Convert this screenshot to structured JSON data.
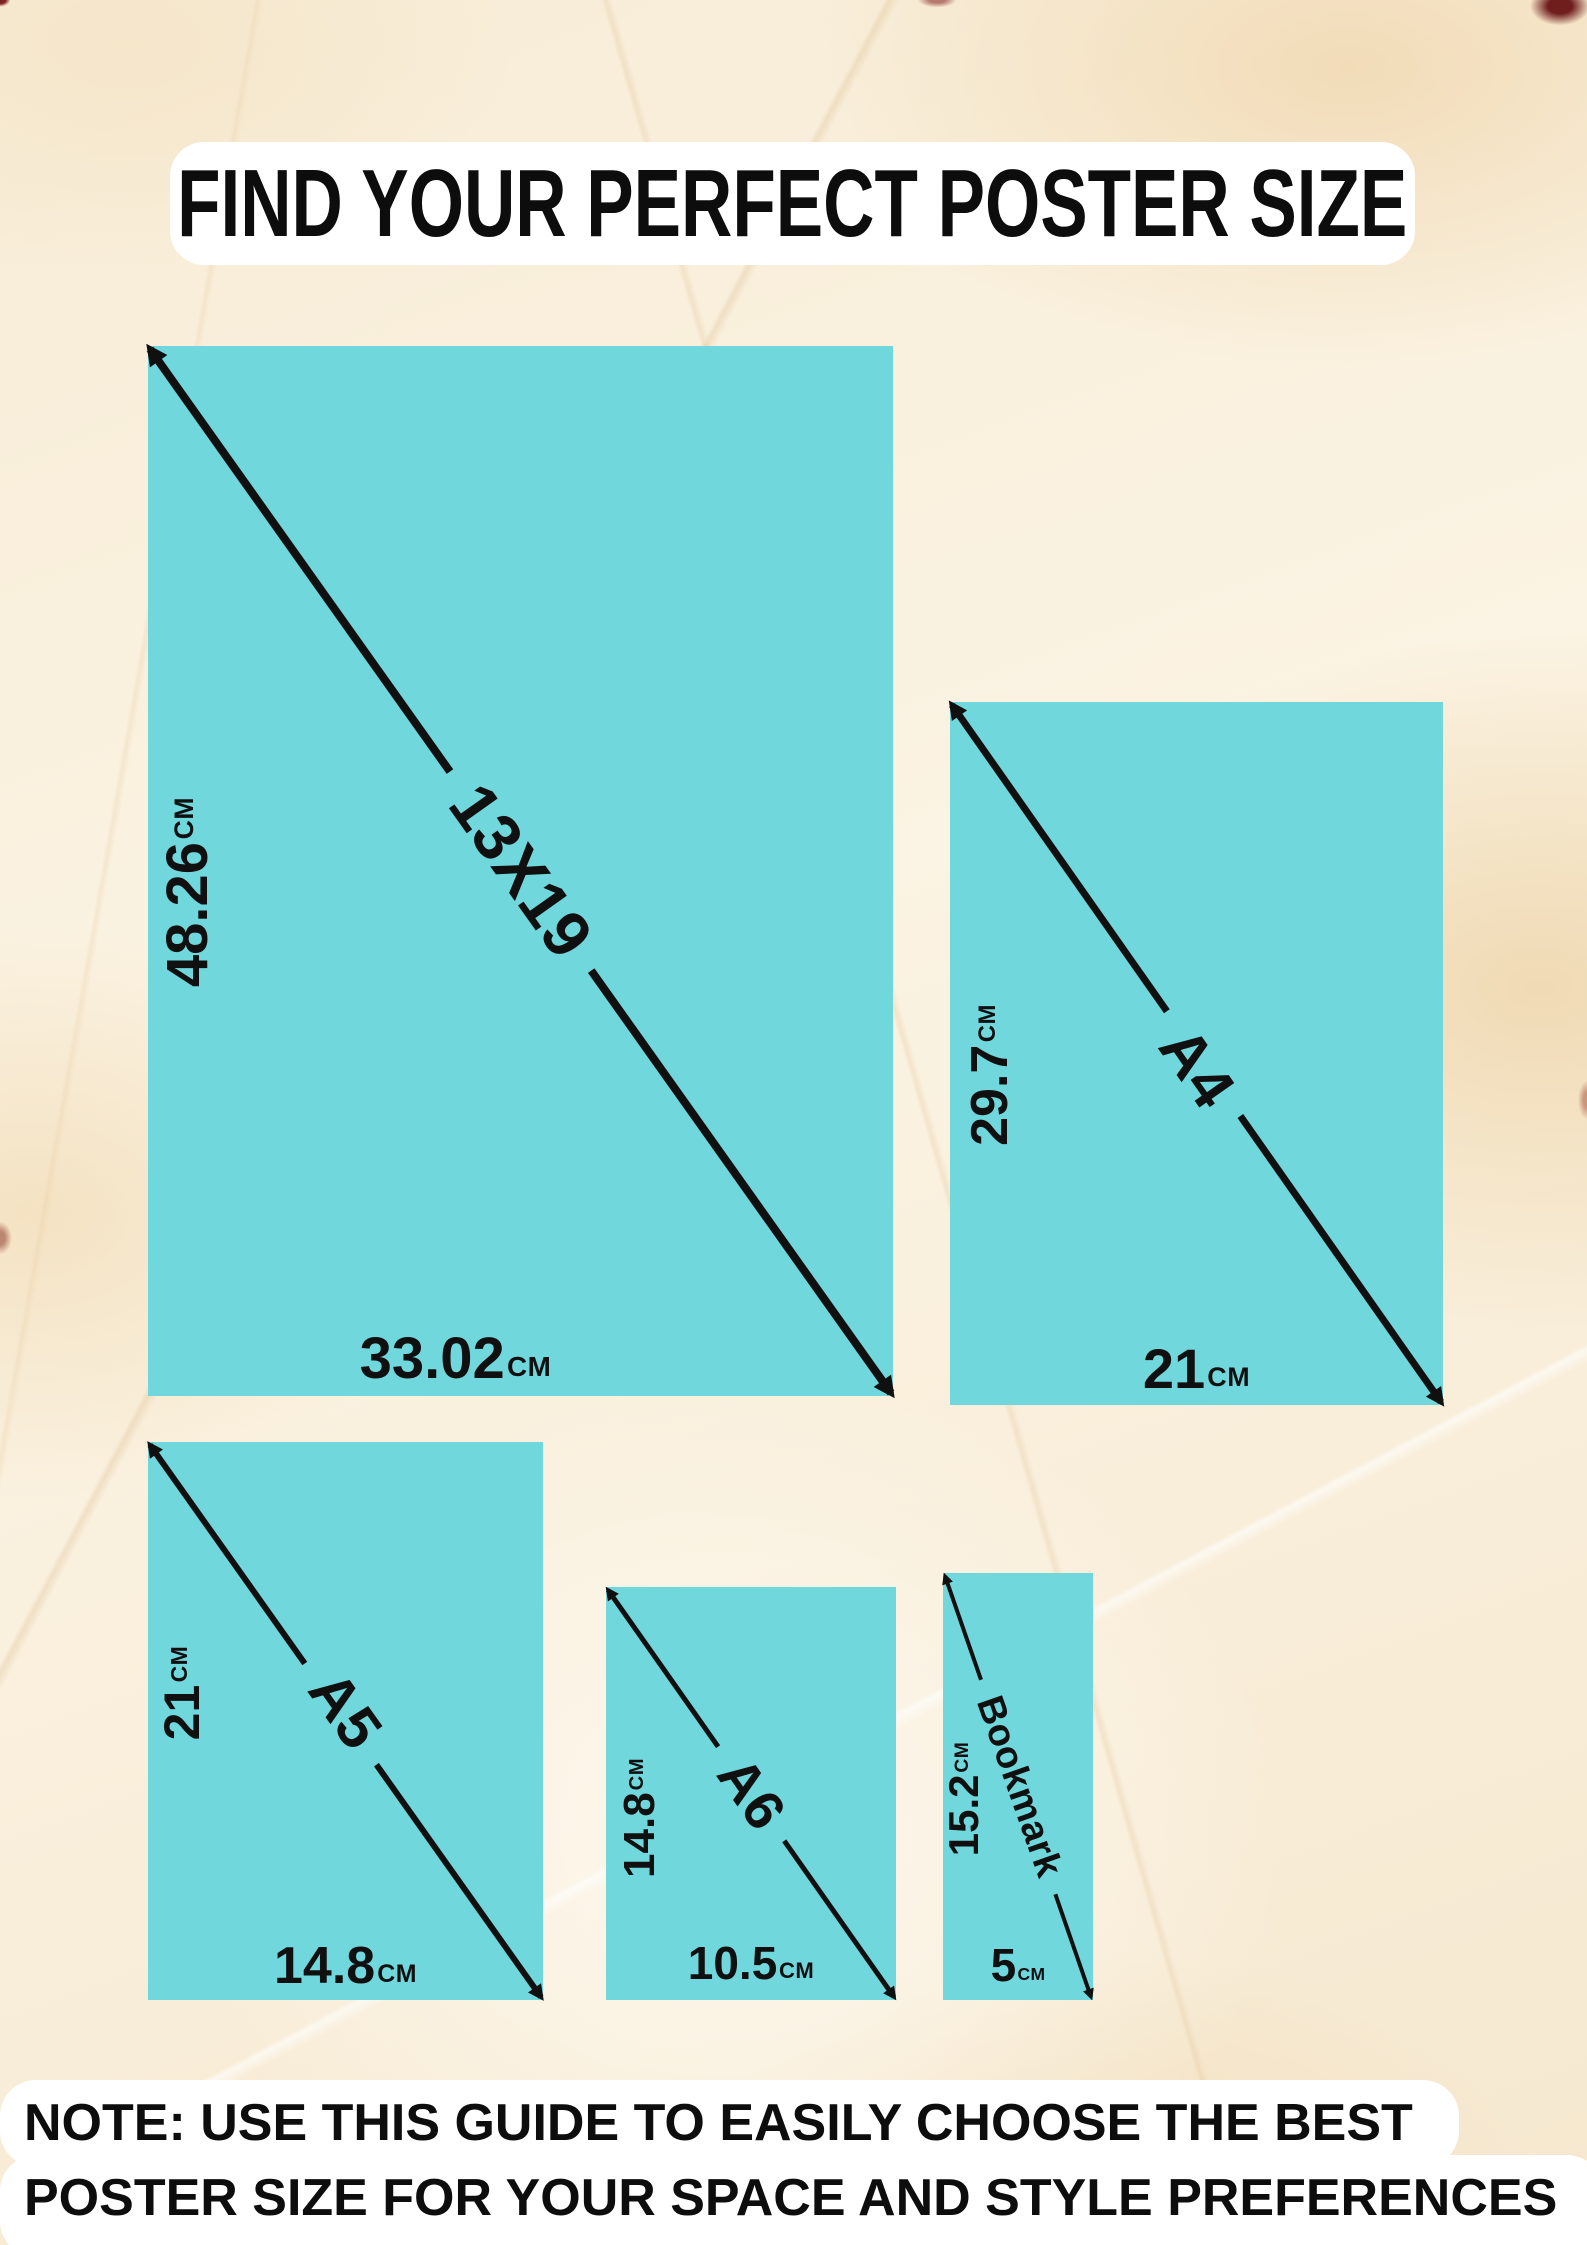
{
  "title": "FIND YOUR PERFECT POSTER SIZE",
  "note": {
    "line1": "NOTE: USE THIS GUIDE TO EASILY CHOOSE THE BEST",
    "line2": "POSTER SIZE FOR YOUR SPACE AND STYLE PREFERENCES"
  },
  "colors": {
    "teal": "#70d8dd",
    "ink": "#101010",
    "panel_white": "#ffffff",
    "marble_cream": "#f8eed9"
  },
  "posters": [
    {
      "id": "13x19",
      "name": "13X19",
      "height_value": "48.26",
      "height_unit": "CM",
      "width_value": "33.02",
      "width_unit": "CM"
    },
    {
      "id": "a4",
      "name": "A4",
      "height_value": "29.7",
      "height_unit": "CM",
      "width_value": "21",
      "width_unit": "CM"
    },
    {
      "id": "a5",
      "name": "A5",
      "height_value": "21",
      "height_unit": "CM",
      "width_value": "14.8",
      "width_unit": "CM"
    },
    {
      "id": "a6",
      "name": "A6",
      "height_value": "14.8",
      "height_unit": "CM",
      "width_value": "10.5",
      "width_unit": "CM"
    },
    {
      "id": "bookmark",
      "name": "Bookmark",
      "height_value": "15.2",
      "height_unit": "CM",
      "width_value": "5",
      "width_unit": "CM"
    }
  ]
}
